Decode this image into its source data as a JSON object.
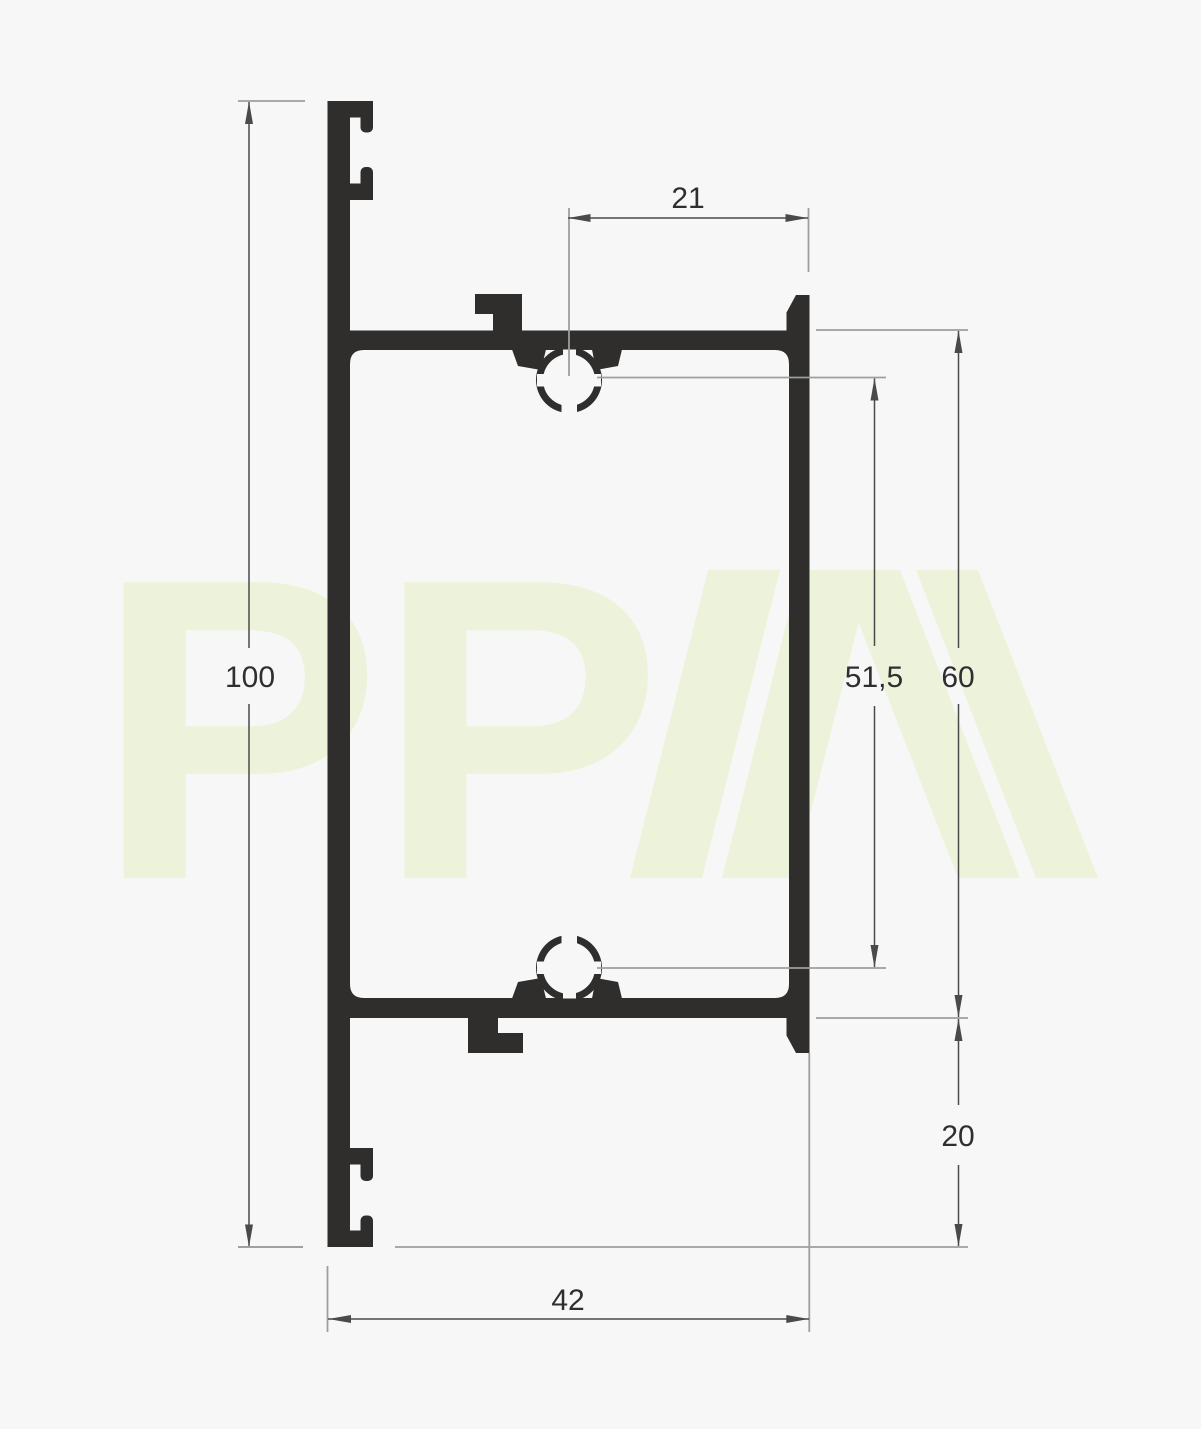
{
  "watermark": {
    "pp_text": "PP",
    "brand_glyph": "PPA",
    "color": "#edf3da"
  },
  "colors": {
    "background": "#f7f7f7",
    "profile": "#2f2e2d",
    "dim_line": "#4a4a4a",
    "ext_line": "#9e9e9e",
    "label": "#2f2f2f",
    "watermark": "#edf3da"
  },
  "dimensions": {
    "top_width": {
      "label": "21"
    },
    "overall_height": {
      "label": "100"
    },
    "boss_spacing": {
      "label": "51,5"
    },
    "box_height": {
      "label": "60"
    },
    "bottom_flange": {
      "label": "20"
    },
    "overall_width": {
      "label": "42"
    }
  }
}
